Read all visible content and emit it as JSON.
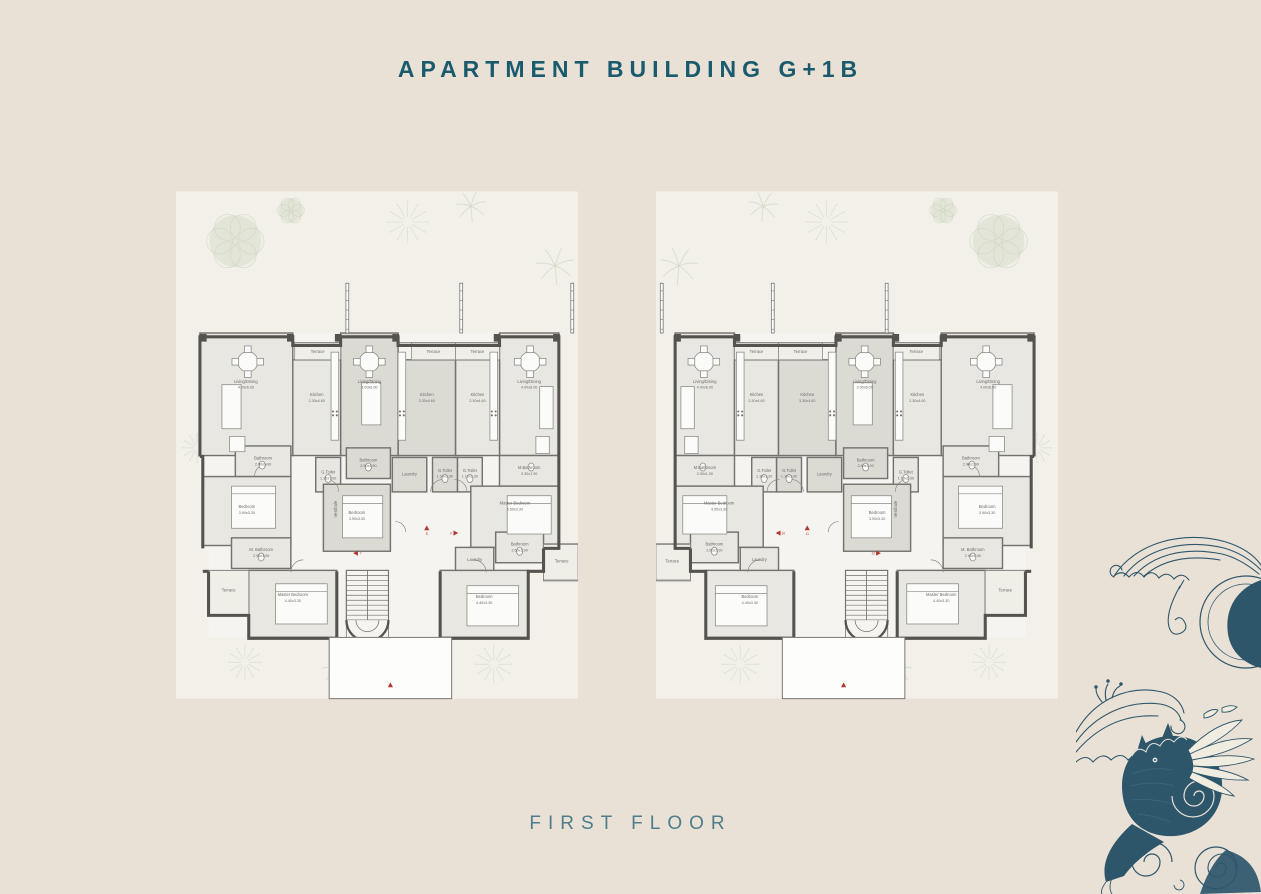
{
  "page": {
    "title": "APARTMENT BUILDING G+1B",
    "floor_label": "FIRST FLOOR",
    "bg": "#e9e1d5",
    "title_color": "#1a5a6d",
    "floor_label_color": "#4e7d8b",
    "illustration_color": "#2d566b"
  },
  "floorplan": {
    "w": 420,
    "h": 530,
    "plot_fill": "#f2f0e8",
    "base_fill": "#f5f4f0",
    "room_fill": "#e8e7e2",
    "tint_fill": "#dbdbd4",
    "terrace_fill": "#efeee7",
    "wall": "#56534f",
    "mid": "#75726e",
    "thin": "#8b8984",
    "furn_fill": "#fbfbf9",
    "label_color": "#6f6c67",
    "red": "#b13a2e",
    "tree_color": "#c9d2bd",
    "base": [
      [
        20,
        148,
        375,
        162
      ],
      [
        20,
        310,
        372,
        66
      ],
      [
        36,
        376,
        350,
        22
      ],
      [
        52,
        396,
        92,
        70
      ],
      [
        252,
        396,
        134,
        70
      ],
      [
        144,
        376,
        116,
        90
      ]
    ],
    "walls": [
      "M20,277 V152 H82 V161 H188 V152 H248 V161 H298 V152 H395 V277",
      "M395,277 H392 V373",
      "M20,277 V373 H36",
      "M36,373 V397 H52 V467 H144 V473",
      "M144,397 V467",
      "M252,397 V467 H344 V443 H386 V397",
      "M386,397 H392"
    ],
    "thin_paths": [
      "M0,369 H36 V407 H0",
      "M82,158 H188",
      "M248,158 H298",
      "M198,397 V467",
      "M242,397 V467",
      "M344,396 H386 V443"
    ],
    "stubs": [
      6,
      122,
      241
    ],
    "stairs": {
      "x": 198,
      "y": 396,
      "w": 44,
      "h": 52,
      "treads": 9
    },
    "entry": {
      "x": 132,
      "y": 466,
      "w": 128,
      "h": 64
    },
    "arcs": [
      [
        116,
        314,
        13,
        0
      ],
      [
        154,
        314,
        13,
        1
      ],
      [
        250,
        314,
        13,
        0
      ],
      [
        338,
        298,
        13,
        1
      ],
      [
        96,
        398,
        13,
        0
      ],
      [
        300,
        398,
        13,
        1
      ],
      [
        180,
        356,
        11,
        0
      ]
    ],
    "rooms": [
      {
        "name": "Living/Dining",
        "dims": "4.00x6.00",
        "rect": [
          20,
          148,
          62,
          128
        ],
        "label": [
          51,
          200
        ]
      },
      {
        "name": "Kitchen",
        "dims": "2.30x4.60",
        "rect": [
          82,
          176,
          46,
          100
        ],
        "label": [
          105,
          214
        ]
      },
      {
        "name": "Kitchen",
        "dims": "3.30x4.60",
        "rect": [
          128,
          176,
          60,
          100
        ],
        "label": [
          158,
          214
        ],
        "tint": true
      },
      {
        "name": "Living/Dining",
        "dims": "3.00x6.00",
        "rect": [
          188,
          148,
          60,
          128
        ],
        "label": [
          218,
          200
        ],
        "tint": true
      },
      {
        "name": "Kitchen",
        "dims": "2.30x4.60",
        "rect": [
          248,
          176,
          50,
          100
        ],
        "label": [
          273,
          214
        ]
      },
      {
        "name": "Living/Dining",
        "dims": "4.00x6.00",
        "rect": [
          298,
          148,
          97,
          128
        ],
        "label": [
          347,
          200
        ]
      },
      {
        "name": "Terrace",
        "dims": "",
        "rect": [
          82,
          158,
          46,
          18
        ],
        "label": [
          105,
          169
        ],
        "terrace": true
      },
      {
        "name": "Terrace",
        "dims": "",
        "rect": [
          128,
          158,
          46,
          18
        ],
        "label": [
          151,
          169
        ],
        "terrace": true
      },
      {
        "name": "Terrace",
        "dims": "",
        "rect": [
          248,
          158,
          48,
          18
        ],
        "label": [
          272,
          169
        ],
        "terrace": true
      },
      {
        "name": "M.Bathroom",
        "dims": "3.30x1.90",
        "rect": [
          20,
          276,
          62,
          32
        ],
        "label": [
          51,
          290
        ]
      },
      {
        "name": "G.Toilet",
        "dims": "1.10x1.30",
        "rect": [
          100,
          278,
          26,
          36
        ],
        "label": [
          113,
          293
        ]
      },
      {
        "name": "G.Toilet",
        "dims": "1.10x1.90",
        "rect": [
          126,
          278,
          26,
          36
        ],
        "label": [
          139,
          293
        ],
        "tint": true
      },
      {
        "name": "Laundry",
        "dims": "",
        "rect": [
          158,
          278,
          36,
          36
        ],
        "label": [
          176,
          297
        ],
        "tint": true
      },
      {
        "name": "Bathroom",
        "dims": "2.90x1.90",
        "rect": [
          196,
          268,
          46,
          32
        ],
        "label": [
          219,
          282
        ],
        "tint": true
      },
      {
        "name": "G.Toilet",
        "dims": "1.10x1.90",
        "rect": [
          248,
          278,
          26,
          36
        ],
        "label": [
          261,
          295
        ]
      },
      {
        "name": "Bathroom",
        "dims": "2.90x1.90",
        "rect": [
          300,
          266,
          58,
          32
        ],
        "label": [
          329,
          280
        ]
      },
      {
        "name": "Master Bedroom",
        "dims": "4.50x3.30",
        "rect": [
          20,
          308,
          92,
          64
        ],
        "label": [
          66,
          327
        ]
      },
      {
        "name": "Bedroom",
        "dims": "3.90x3.30",
        "rect": [
          196,
          306,
          70,
          70
        ],
        "label": [
          231,
          337
        ],
        "tint": true
      },
      {
        "name": "Bedroom",
        "dims": "3.90x3.30",
        "rect": [
          300,
          298,
          92,
          72
        ],
        "label": [
          346,
          331
        ]
      },
      {
        "name": "Vestibule",
        "dims": "",
        "label": [
          252,
          332
        ],
        "rot": true,
        "tint": true
      },
      {
        "name": "Bathroom",
        "dims": "2.60x1.90",
        "rect": [
          36,
          356,
          50,
          32
        ],
        "label": [
          61,
          370
        ]
      },
      {
        "name": "Laundry",
        "dims": "",
        "rect": [
          88,
          372,
          40,
          26
        ],
        "label": [
          108,
          386
        ]
      },
      {
        "name": "Terrace",
        "dims": "",
        "rect": [
          0,
          368,
          36,
          38
        ],
        "label": [
          17,
          388
        ],
        "terrace": true
      },
      {
        "name": "M. Bathroom",
        "dims": "2.90x1.90",
        "rect": [
          300,
          362,
          62,
          32
        ],
        "label": [
          331,
          376
        ]
      },
      {
        "name": "Bedroom",
        "dims": "4.40x3.30",
        "rect": [
          52,
          396,
          92,
          70
        ],
        "label": [
          98,
          425
        ]
      },
      {
        "name": "Master Bedroom",
        "dims": "4.40x3.30",
        "rect": [
          252,
          396,
          92,
          70
        ],
        "label": [
          298,
          423
        ]
      },
      {
        "name": "Terrace",
        "dims": "",
        "rect": [
          344,
          396,
          42,
          46
        ],
        "label": [
          365,
          418
        ],
        "terrace": true
      }
    ],
    "furniture": {
      "tables": [
        [
          50,
          178
        ],
        [
          218,
          178
        ],
        [
          345,
          178
        ]
      ],
      "sofas": [
        [
          26,
          204,
          14,
          44
        ],
        [
          206,
          200,
          20,
          44
        ],
        [
          352,
          202,
          20,
          46
        ],
        [
          30,
          256,
          14,
          18
        ],
        [
          348,
          256,
          16,
          16
        ]
      ],
      "counters": [
        [
          84,
          168,
          8,
          92
        ],
        [
          180,
          168,
          8,
          92
        ],
        [
          250,
          168,
          8,
          92
        ]
      ],
      "stoves": [
        [
          88,
          232
        ],
        [
          184,
          232
        ],
        [
          254,
          232
        ]
      ],
      "beds": [
        [
          28,
          318,
          46,
          40
        ],
        [
          204,
          318,
          42,
          44
        ],
        [
          316,
          308,
          46,
          44
        ],
        [
          62,
          412,
          54,
          42
        ],
        [
          262,
          410,
          54,
          42
        ]
      ],
      "fixtures": [
        [
          113,
          300
        ],
        [
          139,
          300
        ],
        [
          219,
          288
        ],
        [
          261,
          300
        ],
        [
          330,
          286
        ],
        [
          61,
          376
        ],
        [
          331,
          382
        ],
        [
          49,
          288
        ]
      ]
    },
    "trees": [
      {
        "t": "round",
        "x": 358,
        "y": 52,
        "r": 30
      },
      {
        "t": "burst",
        "x": 178,
        "y": 32,
        "r": 20
      },
      {
        "t": "fern",
        "x": 112,
        "y": 16,
        "r": 16
      },
      {
        "t": "palm",
        "x": 24,
        "y": 78,
        "r": 20
      },
      {
        "t": "burst",
        "x": 398,
        "y": 268,
        "r": 14
      },
      {
        "t": "burst",
        "x": 88,
        "y": 494,
        "r": 18
      },
      {
        "t": "fern",
        "x": 252,
        "y": 500,
        "r": 15
      },
      {
        "t": "burst",
        "x": 348,
        "y": 492,
        "r": 16
      },
      {
        "t": "round",
        "x": 300,
        "y": 20,
        "r": 14
      }
    ]
  },
  "plans": [
    {
      "id": "left-building",
      "mirror": true,
      "markers": [
        {
          "dir": "right",
          "num": "7",
          "x": 232,
          "y": 378
        },
        {
          "dir": "up",
          "num": "8",
          "x": 158,
          "y": 352
        },
        {
          "dir": "left",
          "num": "9",
          "x": 128,
          "y": 357
        },
        {
          "dir": "up",
          "num": "",
          "x": 196,
          "y": 516
        }
      ]
    },
    {
      "id": "right-building",
      "mirror": false,
      "markers": [
        {
          "dir": "left",
          "num": "10",
          "x": 128,
          "y": 357
        },
        {
          "dir": "up",
          "num": "11",
          "x": 158,
          "y": 352
        },
        {
          "dir": "right",
          "num": "12",
          "x": 232,
          "y": 378
        },
        {
          "dir": "up",
          "num": "",
          "x": 196,
          "y": 516
        }
      ]
    }
  ]
}
